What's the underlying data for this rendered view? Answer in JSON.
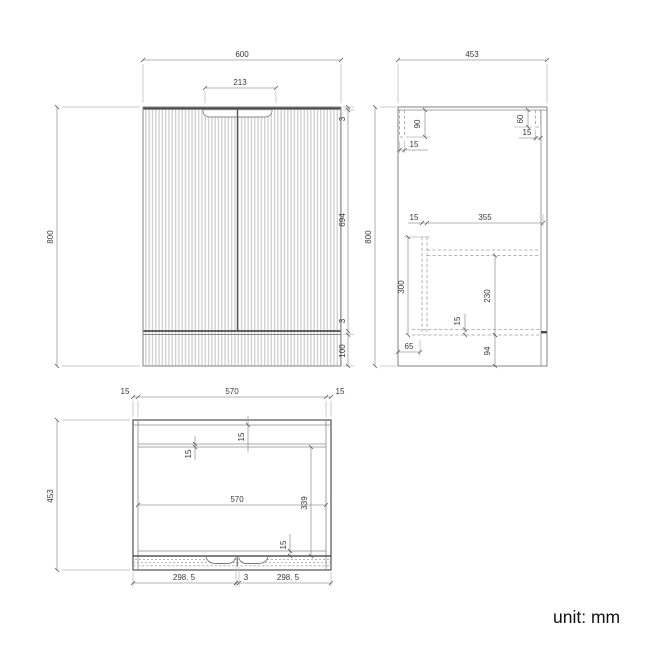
{
  "unit_label": "unit: mm",
  "colors": {
    "outline": "#828282",
    "heavy_line": "#4d4d4d",
    "dim_line": "#9b9b9b",
    "flute_stripe": "#cfcfcf",
    "text": "#3a3a3a"
  },
  "front_view": {
    "width": "600",
    "handle_width": "213",
    "height": "800",
    "top_gap": "3",
    "door_height": "694",
    "bottom_gap": "3",
    "plinth_height": "100"
  },
  "side_view": {
    "depth": "453",
    "height": "800",
    "bracket_left_length": "90",
    "bracket_left_thickness": "15",
    "bracket_right_length": "60",
    "bracket_right_thickness": "15",
    "back_panel_thickness": "15",
    "internal_depth": "355",
    "drawer_zone_height": "300",
    "shelf_space_height": "230",
    "shelf_thickness": "15",
    "back_clearance": "65",
    "bottom_zone_height": "94"
  },
  "plan_view": {
    "left_side_thickness": "15",
    "top_internal_width": "570",
    "right_side_thickness": "15",
    "depth": "453",
    "back_panel_thickness": "15",
    "rail_thickness": "15",
    "internal_width": "570",
    "door_depth": "339",
    "front_panel_thickness": "15",
    "left_door_width": "298. 5",
    "center_gap": "3",
    "right_door_width": "298. 5"
  }
}
